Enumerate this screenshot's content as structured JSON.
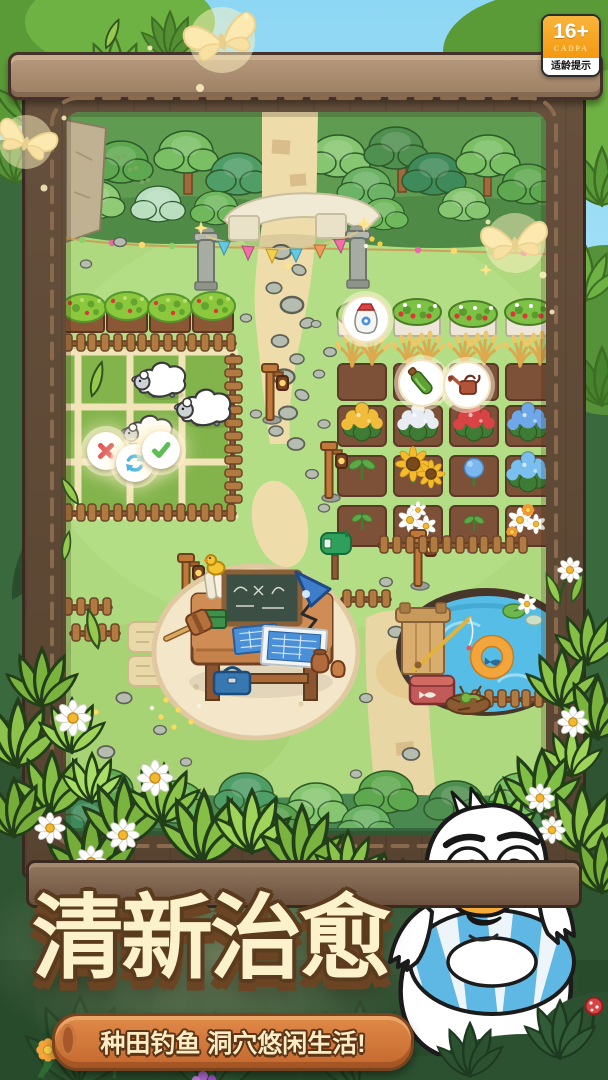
{
  "page": {
    "width": 608,
    "height": 1080,
    "sky_color": "#85d2f2",
    "forest_color": "#35603a",
    "frame_wood": "#5e4938"
  },
  "age_badge": {
    "rating": "16+",
    "organization": "CADPA",
    "caption": "适龄提示",
    "panel_color": "#f5a31d"
  },
  "headline": {
    "text": "清新治愈",
    "fill": "#fbf1ca",
    "outline": "#5b3b1e"
  },
  "tagline": {
    "text": "种田钓鱼 洞穴悠闲生活!",
    "banner_color": "#cf7239",
    "text_color": "#faedc3"
  },
  "pen_actions": {
    "reject": {
      "icon": "cross-icon",
      "color": "#e25555"
    },
    "shuffle": {
      "icon": "refresh-icon",
      "color": "#45b3e6"
    },
    "confirm": {
      "icon": "check-icon",
      "color": "#5cbd52"
    }
  },
  "scene": {
    "bubbles": [
      {
        "icon": "fertilizer-bag-icon"
      },
      {
        "icon": "seed-bottle-icon"
      },
      {
        "icon": "watering-can-icon"
      }
    ],
    "sheep_count": 3,
    "landmarks": [
      "stone-arch",
      "flag-garland",
      "sheep-pen",
      "berry-planters",
      "strawberry-planters",
      "wheat-plots",
      "flower-plots",
      "workbench",
      "chalkboard",
      "desk-lamp",
      "blueprints",
      "toolbox",
      "mailbox",
      "lamp-posts",
      "stone-path",
      "pond",
      "fishing-dock",
      "swim-ring",
      "cooler-box",
      "picket-fences"
    ]
  },
  "mascot": {
    "name": "duck",
    "ring_color": "#5fb7e3"
  }
}
